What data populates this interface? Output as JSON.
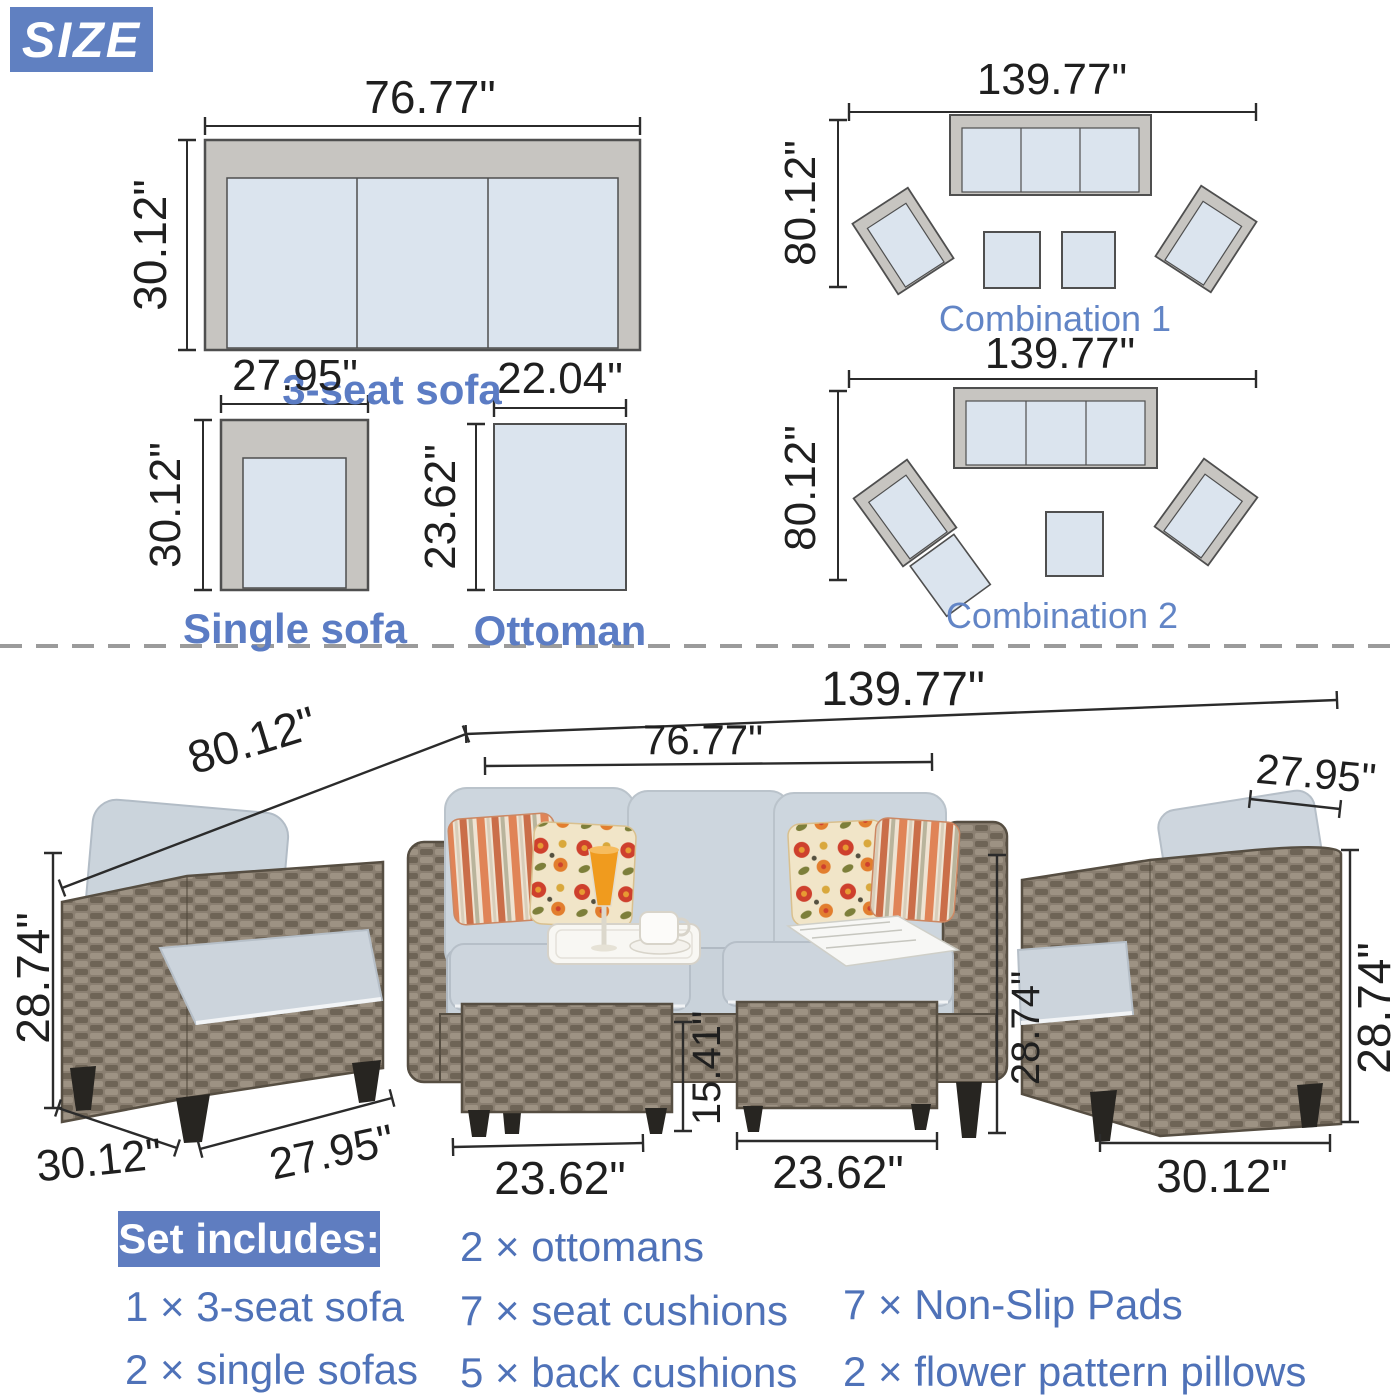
{
  "size_badge": "SIZE",
  "diagrams": {
    "three_seat": {
      "width": "76.77\"",
      "depth": "30.12\"",
      "label": "3-seat sofa"
    },
    "single": {
      "width": "27.95\"",
      "depth": "30.12\"",
      "label": "Single sofa"
    },
    "ottoman": {
      "width": "22.04\"",
      "depth": "23.62\"",
      "label": "Ottoman"
    },
    "combo1": {
      "width": "139.77\"",
      "depth": "80.12\"",
      "label": "Combination 1"
    },
    "combo2": {
      "width": "139.77\"",
      "depth": "80.12\"",
      "label": "Combination 2"
    }
  },
  "photo_dims": {
    "total_width": "139.77\"",
    "total_depth": "80.12\"",
    "sofa_width": "76.77\"",
    "right_chair_width": "27.95\"",
    "left_chair_height": "28.74\"",
    "left_chair_depth": "30.12\"",
    "left_chair_width": "27.95\"",
    "ottoman1_width": "23.62\"",
    "ottoman_height": "15.41\"",
    "ottoman2_width": "23.62\"",
    "sofa_height": "28.74\"",
    "right_chair_height": "28.74\"",
    "right_chair_depth": "30.12\""
  },
  "set_includes": {
    "title": "Set includes:",
    "col1": [
      "1 × 3-seat sofa",
      "2 × single sofas"
    ],
    "col2": [
      "2 × ottomans",
      "7 × seat cushions",
      "5 × back cushions"
    ],
    "col3": [
      "7 × Non-Slip Pads",
      "2 × flower pattern pillows"
    ]
  },
  "colors": {
    "accent_blue": "#5b7cc4",
    "badge_blue": "#6080c1",
    "dim_text": "#1f1f1f"
  }
}
